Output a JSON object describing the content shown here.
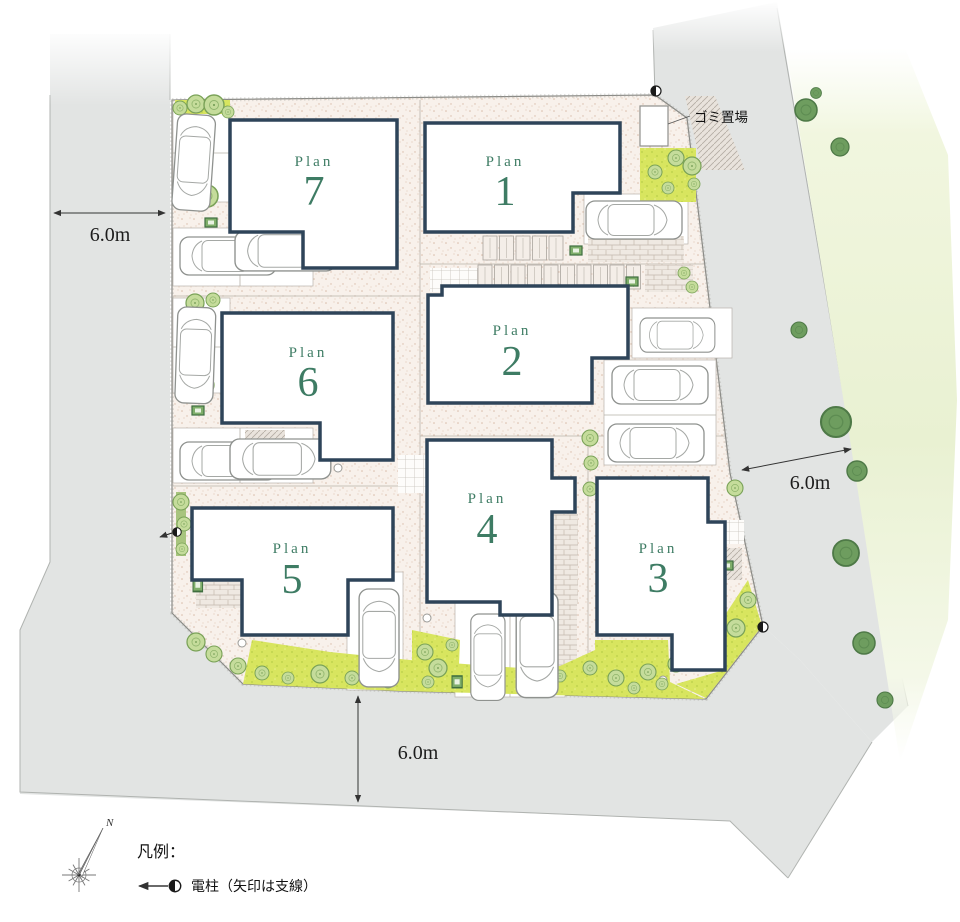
{
  "plans": [
    {
      "prefix": "Plan",
      "number": "1"
    },
    {
      "prefix": "Plan",
      "number": "2"
    },
    {
      "prefix": "Plan",
      "number": "3"
    },
    {
      "prefix": "Plan",
      "number": "4"
    },
    {
      "prefix": "Plan",
      "number": "5"
    },
    {
      "prefix": "Plan",
      "number": "6"
    },
    {
      "prefix": "Plan",
      "number": "7"
    }
  ],
  "dimensions": {
    "left_road_width": "6.0m",
    "right_road_width": "6.0m",
    "bottom_road_width": "6.0m"
  },
  "garbage": {
    "label": "ゴミ置場"
  },
  "legend": {
    "title": "凡例：",
    "pole_label": "電柱（矢印は支線）"
  },
  "compass": {
    "north": "N"
  },
  "colors": {
    "house_outline": "#2e4459",
    "plan_text": "#3e7c64",
    "road": "#e2e4e3",
    "site_ground": "#f8f1eb",
    "lawn": "#d8e55f",
    "tree_light": "#c5dc9b",
    "tree_dark": "#6e9d5f"
  }
}
